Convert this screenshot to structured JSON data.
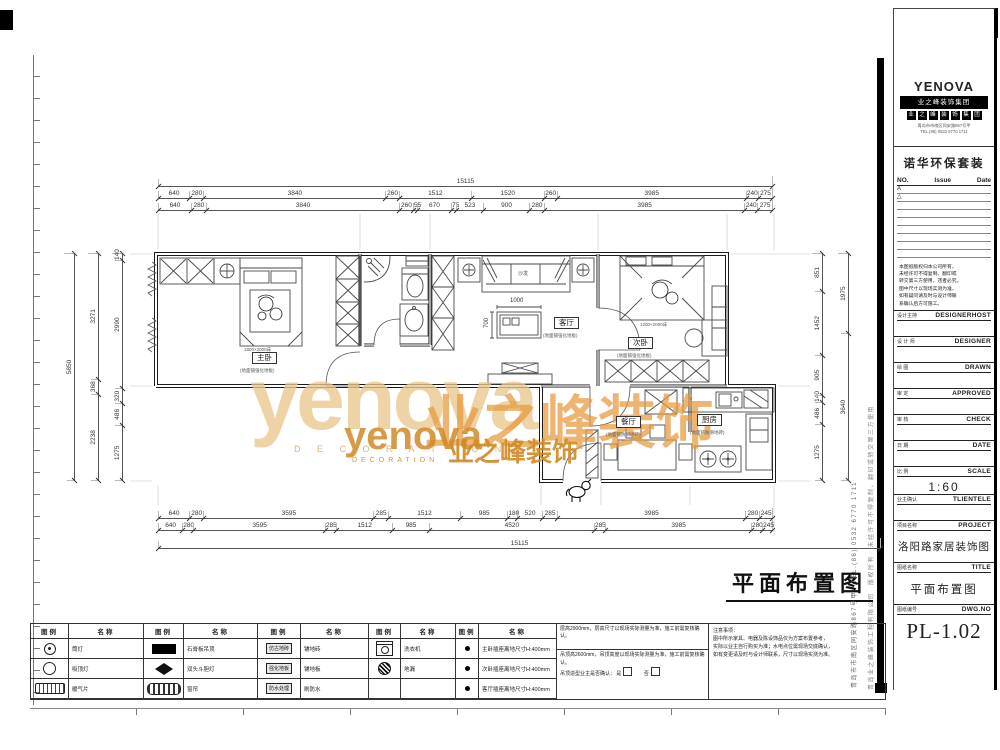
{
  "watermark": {
    "brand": "yenova",
    "brand_sub": "D E C O R A T I O N",
    "cn_big": "业之峰装饰",
    "overlay_brand": "yenova",
    "overlay_cn": "业之峰装饰",
    "overlay_sub": "DECORATION"
  },
  "plan": {
    "title": "平面布置图",
    "rooms": {
      "master": {
        "label": "主卧",
        "note": "(地面铺强化地板)"
      },
      "living": {
        "label": "客厅",
        "note": "(地面铺强化地板)"
      },
      "second": {
        "label": "次卧",
        "note": "(地面铺强化地板)"
      },
      "dining": {
        "label": "餐厅",
        "note": "(地面铺防滑地砖)"
      },
      "kitchen": {
        "label": "厨房",
        "note": "(地面铺防滑地砖)"
      }
    },
    "furniture": {
      "sofa": "沙发",
      "bed_master": "1800×2000床",
      "bed_second": "1200×2000床",
      "table_w": "1000",
      "table_h": "700"
    }
  },
  "dims": {
    "top_overall": [
      "15115"
    ],
    "top_row1": [
      "640",
      "280",
      "3840",
      "260",
      "1512",
      "1520",
      "260",
      "3985",
      "240",
      "275"
    ],
    "top_row2": [
      "640",
      "280",
      "3840",
      "260",
      "55",
      "670",
      "75",
      "523",
      "900",
      "280",
      "3985",
      "240",
      "275"
    ],
    "bottom_row1": [
      "640",
      "280",
      "3595",
      "285",
      "1512",
      "985",
      "180",
      "520",
      "285",
      "3985",
      "280",
      "245"
    ],
    "bottom_row2": [
      "640",
      "280",
      "3595",
      "285",
      "1512",
      "985",
      "4520",
      "285",
      "3985",
      "280",
      "245"
    ],
    "bottom_overall": [
      "15115"
    ],
    "left_inner": [
      "1275",
      "486",
      "320",
      "2990",
      "140"
    ],
    "left_mid": [
      "2238",
      "368",
      "3271"
    ],
    "left_overall": [
      "5850"
    ],
    "right_inner": [
      "1275",
      "486",
      "140",
      "905",
      "1452",
      "851"
    ],
    "right_mid": [
      "3640",
      "1975"
    ],
    "right_overall": [
      "5850"
    ]
  },
  "legend": {
    "header": {
      "sym": "图例",
      "name": "名称"
    },
    "groups": [
      {
        "rows": [
          {
            "name": "筒灯"
          },
          {
            "name": "吸顶灯"
          },
          {
            "name": "暖气片"
          }
        ]
      },
      {
        "rows": [
          {
            "name": "石膏板吊顶"
          },
          {
            "name": "双头斗胆灯"
          },
          {
            "name": "窗帘"
          }
        ]
      },
      {
        "rows": [
          {
            "sym_label": "仿古地砖",
            "name": "铺地砖"
          },
          {
            "sym_label": "强化地板",
            "name": "铺地板"
          },
          {
            "sym_label": "防水处理",
            "name": "刷防水"
          }
        ]
      },
      {
        "rows": [
          {
            "name": "洗衣机"
          },
          {
            "name": "地漏"
          },
          {
            "name": ""
          }
        ]
      },
      {
        "rows": [
          {
            "name": "主卧插座离地尺寸H:400mm"
          },
          {
            "name": "次卧插座离地尺寸H:400mm"
          },
          {
            "name": "客厅插座离地尺寸H:400mm"
          }
        ]
      }
    ],
    "notes": {
      "line1": "层高2900mm，层高尺寸以现场实际测量为准，施工前需复核确认。",
      "line2": "吊顶高2600mm，吊顶高度以现场实际测量为准，施工前需复核确认。",
      "confirm": "吊顶造型业主是否确认：",
      "yes": "是",
      "no": "否"
    },
    "remark_lines": [
      "注意事项：",
      "图中所示家具、电器及陈设饰品仅为方案布置参考，",
      "实际以业主自行购买为准；水电点位需现场交底确认，",
      "如有变更请及时与设计师联系，尺寸以现场实测为准。"
    ]
  },
  "sidebar": {
    "logo": {
      "brand": "YENOVA",
      "bar": "业之峰装饰集团",
      "blocks": [
        "业",
        "之",
        "峰",
        "装",
        "饰",
        "集",
        "团"
      ],
      "addr1": "青岛市市南区同安路867号甲",
      "addr2": "TEL.(86) 0532 6770 1711"
    },
    "package": "诺华环保套装",
    "issue": {
      "no": "NO.",
      "issue": "Issue",
      "date": "Date",
      "rows": [
        "A",
        "△"
      ]
    },
    "disclaimer": [
      "本图纸版权归本公司所有，",
      "未经许可不得复制、翻印或",
      "转交第三方使用，违者必究。",
      "图中尺寸以现场实测为准，",
      "如有疑问请及时与设计师联",
      "系确认后方可施工。"
    ],
    "fields": [
      {
        "cn": "设计主持",
        "en": "DESIGNERHOST",
        "value": ""
      },
      {
        "cn": "设 计 师",
        "en": "DESIGNER",
        "value": ""
      },
      {
        "cn": "绘  图",
        "en": "DRAWN",
        "value": ""
      },
      {
        "cn": "审  定",
        "en": "APPROVED",
        "value": ""
      },
      {
        "cn": "审  核",
        "en": "CHECK",
        "value": ""
      },
      {
        "cn": "日  期",
        "en": "DATE",
        "value": ""
      },
      {
        "cn": "比  例",
        "en": "SCALE",
        "value": "1:60"
      },
      {
        "cn": "业主确认",
        "en": "TLIENTELE",
        "value": ""
      },
      {
        "cn": "项目名称",
        "en": "PROJECT",
        "value": "洛阳路家居装饰图"
      },
      {
        "cn": "图纸名称",
        "en": "TITLE",
        "value": "平面布置图"
      },
      {
        "cn": "图纸编号",
        "en": "DWG.NO",
        "value": "PL-1.02"
      }
    ]
  },
  "vertical_texts": {
    "address": "青岛市市南区同安路867号甲　TEL.(86) 0532 6770 1711",
    "copyright": "青岛业之峰装饰工程有限公司　版权所有　未经许可不得复制、翻印或转交第三方使用"
  }
}
